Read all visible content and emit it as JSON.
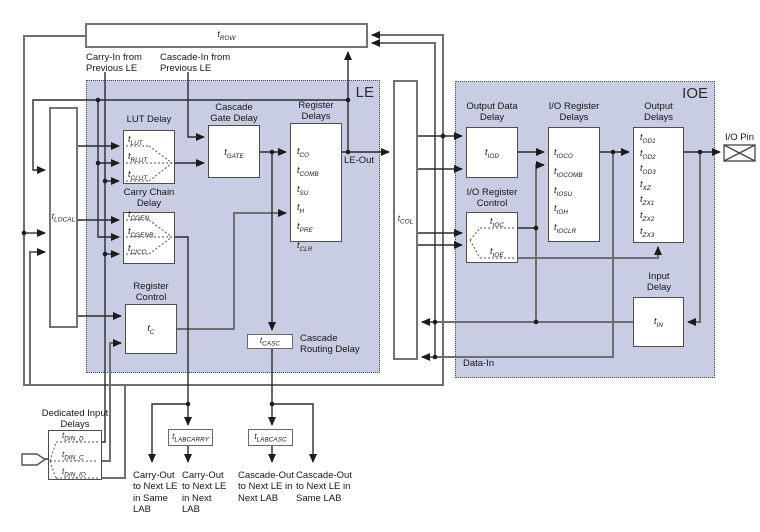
{
  "delay_prefix": "t",
  "interconnect": {
    "row_sub": "ROW",
    "col_sub": "COL",
    "local_sub": "LOCAL"
  },
  "inputs": {
    "carry_in": "Carry-In from Previous LE",
    "cascade_in": "Cascade-In from Previous LE"
  },
  "le": {
    "title": "LE",
    "lut": {
      "title": "LUT Delay",
      "items": [
        "LUT",
        "RLUT",
        "CLUT"
      ]
    },
    "cascade_gate": {
      "title": "Cascade Gate Delay",
      "sub": "GATE"
    },
    "register_delays": {
      "title": "Register Delays",
      "items": [
        "CO",
        "COMB",
        "SU",
        "H",
        "PRE",
        "CLR"
      ]
    },
    "carry_chain": {
      "title": "Carry Chain Delay",
      "items": [
        "CGEN",
        "CGENR",
        "CICO"
      ]
    },
    "register_control": {
      "title": "Register Control",
      "sub": "C"
    },
    "cascade_routing": {
      "title": "Cascade Routing Delay",
      "sub": "CASC"
    }
  },
  "ioe": {
    "title": "IOE",
    "output_data_delay": {
      "title": "Output Data Delay",
      "sub": "IOD"
    },
    "io_register_delays": {
      "title": "I/O Register Delays",
      "items": [
        "IOCO",
        "IOCOMB",
        "IOSU",
        "IOH",
        "IOCLR"
      ]
    },
    "output_delays": {
      "title": "Output Delays",
      "items": [
        "OD1",
        "OD2",
        "OD3",
        "XZ",
        "ZX1",
        "ZX2",
        "ZX3"
      ]
    },
    "io_register_control": {
      "title": "I/O Register Control",
      "items": [
        "IOC",
        "IOE"
      ]
    },
    "input_delay": {
      "title": "Input Delay",
      "sub": "IN"
    }
  },
  "lab": {
    "dedicated_title": "Dedicated Input Delays",
    "dedicated_items": [
      "DIN_D",
      "DIN_C",
      "DIN_IO"
    ],
    "labcarry_sub": "LABCARRY",
    "labcasc_sub": "LABCASC"
  },
  "labels": {
    "le_out": "LE-Out",
    "data_in": "Data-In",
    "io_pin": "I/O Pin"
  },
  "outputs": {
    "carry_same": "Carry-Out to Next LE in Same LAB",
    "carry_next": "Carry-Out to Next LE in Next LAB",
    "casc_next": "Cascade-Out to Next LE in Next LAB",
    "casc_same": "Cascade-Out to Next LE in Same LAB"
  },
  "colors": {
    "region_fill": "#c9cde4",
    "box_border": "#4d4d4d",
    "wire_dark": "#2b2b2b",
    "wire_gray": "#6e6e6e"
  }
}
